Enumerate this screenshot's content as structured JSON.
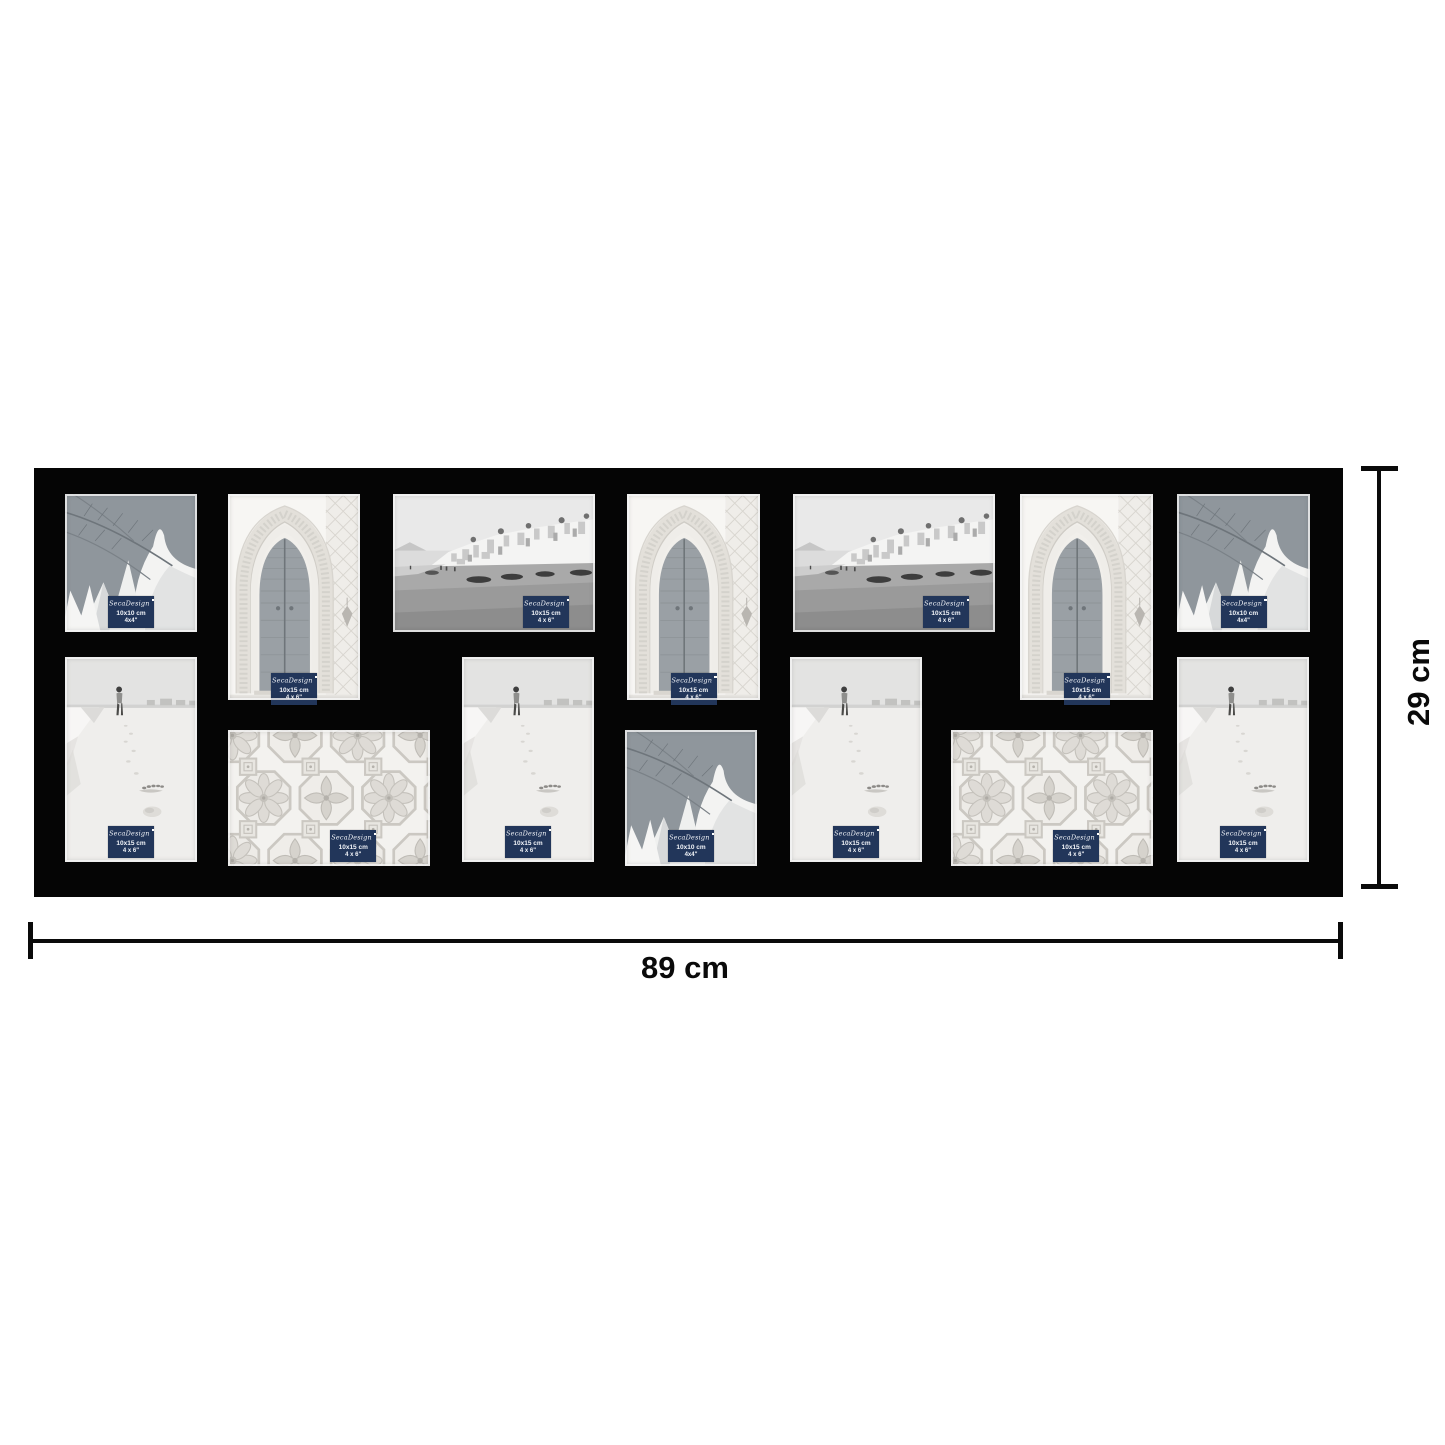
{
  "page": {
    "background": "#ffffff"
  },
  "dimensions": {
    "width_label": "89 cm",
    "height_label": "29 cm"
  },
  "frame": {
    "color": "#050505",
    "rows": 2,
    "opening_count": 14
  },
  "sticker": {
    "brand": "SecaDesign",
    "bg_color": "#22365a",
    "text_color": "#f2f4f8"
  },
  "collage": {
    "openings": [
      {
        "type": "palm",
        "photo": "palm-leaves",
        "size_cm": "10x10 cm",
        "size_in": "4x4\"",
        "x": 31,
        "y": 26,
        "w": 132,
        "h": 138,
        "label_pos": "center"
      },
      {
        "type": "door",
        "photo": "moroccan-door",
        "size_cm": "10x15 cm",
        "size_in": "4 x 6\"",
        "x": 194,
        "y": 26,
        "w": 132,
        "h": 206,
        "label_pos": "overflow"
      },
      {
        "type": "town",
        "photo": "beach-town",
        "size_cm": "10x15 cm",
        "size_in": "4 x 6\"",
        "x": 359,
        "y": 26,
        "w": 202,
        "h": 138,
        "label_pos": "right"
      },
      {
        "type": "door",
        "photo": "moroccan-door",
        "size_cm": "10x15 cm",
        "size_in": "4 x 6\"",
        "x": 593,
        "y": 26,
        "w": 133,
        "h": 206,
        "label_pos": "overflow"
      },
      {
        "type": "town",
        "photo": "beach-town",
        "size_cm": "10x15 cm",
        "size_in": "4 x 6\"",
        "x": 759,
        "y": 26,
        "w": 202,
        "h": 138,
        "label_pos": "right"
      },
      {
        "type": "door",
        "photo": "moroccan-door",
        "size_cm": "10x15 cm",
        "size_in": "4 x 6\"",
        "x": 986,
        "y": 26,
        "w": 133,
        "h": 206,
        "label_pos": "overflow"
      },
      {
        "type": "palm",
        "photo": "palm-leaves",
        "size_cm": "10x10 cm",
        "size_in": "4x4\"",
        "x": 1143,
        "y": 26,
        "w": 133,
        "h": 138,
        "label_pos": "center"
      },
      {
        "type": "walker",
        "photo": "beach-walker",
        "size_cm": "10x15 cm",
        "size_in": "4 x 6\"",
        "x": 31,
        "y": 189,
        "w": 132,
        "h": 205,
        "label_pos": "center"
      },
      {
        "type": "tiles",
        "photo": "moroccan-tiles",
        "size_cm": "10x15 cm",
        "size_in": "4 x 6\"",
        "x": 194,
        "y": 262,
        "w": 202,
        "h": 136,
        "label_pos": "center-right"
      },
      {
        "type": "walker",
        "photo": "beach-walker",
        "size_cm": "10x15 cm",
        "size_in": "4 x 6\"",
        "x": 428,
        "y": 189,
        "w": 132,
        "h": 205,
        "label_pos": "center"
      },
      {
        "type": "palm",
        "photo": "palm-leaves",
        "size_cm": "10x10 cm",
        "size_in": "4x4\"",
        "x": 591,
        "y": 262,
        "w": 132,
        "h": 136,
        "label_pos": "center"
      },
      {
        "type": "walker",
        "photo": "beach-walker",
        "size_cm": "10x15 cm",
        "size_in": "4 x 6\"",
        "x": 756,
        "y": 189,
        "w": 132,
        "h": 205,
        "label_pos": "center"
      },
      {
        "type": "tiles",
        "photo": "moroccan-tiles",
        "size_cm": "10x15 cm",
        "size_in": "4 x 6\"",
        "x": 917,
        "y": 262,
        "w": 202,
        "h": 136,
        "label_pos": "center-right"
      },
      {
        "type": "walker",
        "photo": "beach-walker",
        "size_cm": "10x15 cm",
        "size_in": "4 x 6\"",
        "x": 1143,
        "y": 189,
        "w": 132,
        "h": 205,
        "label_pos": "center"
      }
    ]
  }
}
